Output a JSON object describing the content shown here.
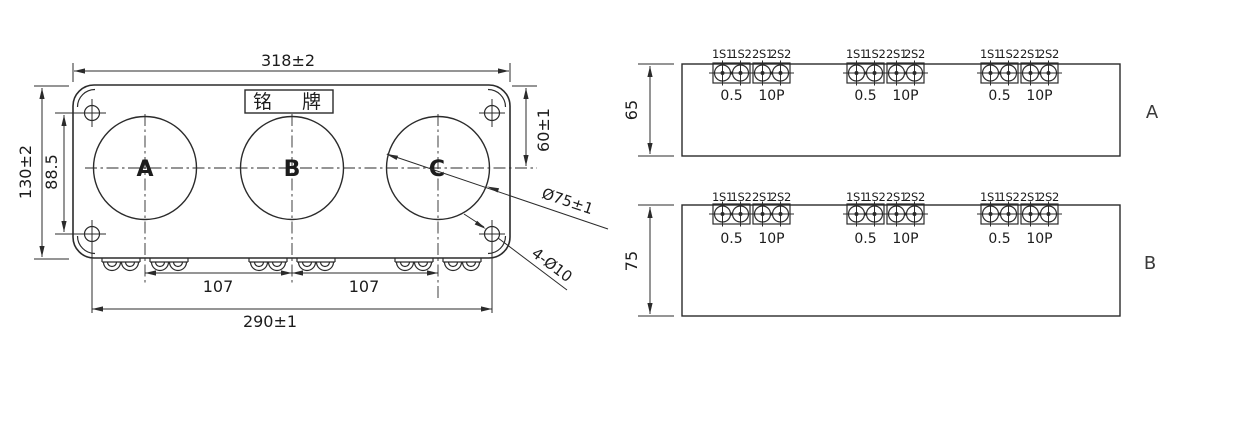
{
  "front_view": {
    "nameplate": "铭牌",
    "phase_labels": {
      "a": "A",
      "b": "B",
      "c": "C"
    },
    "dimensions": {
      "overall_width": "318±2",
      "overall_height": "130±2",
      "mount_hole_row_pitch": "88.5",
      "top_to_window_center": "60±1",
      "window_diameter": "Ø75±1",
      "mount_holes": "4-Ø10",
      "window_pitch_left": "107",
      "window_pitch_right": "107",
      "mount_hole_column_pitch": "290±1"
    }
  },
  "terminal_views": {
    "terminal_labels": [
      "1S1",
      "1S2",
      "2S1",
      "2S2"
    ],
    "accuracy_class_left": "0.5",
    "accuracy_class_right": "10P",
    "rows": [
      {
        "label": "A",
        "height": "65"
      },
      {
        "label": "B",
        "height": "75"
      }
    ]
  },
  "colors": {
    "line": "#2b2b2b",
    "background": "#ffffff"
  }
}
